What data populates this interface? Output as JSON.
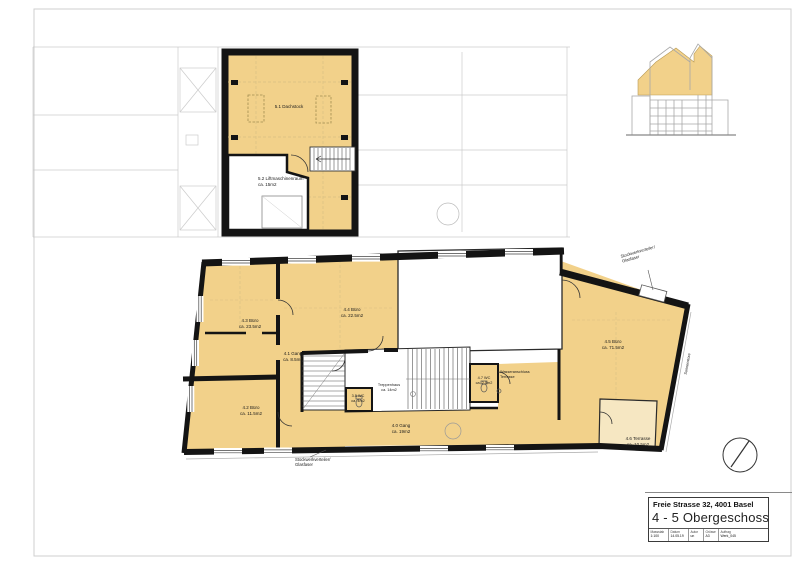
{
  "colors": {
    "room_fill": "#f2d18a",
    "terrace_fill": "#f6e7c2",
    "wall": "#141414",
    "faint_context": "#cccccc"
  },
  "attic": {
    "dachstock_label": "5.1 Dachstock",
    "lift_room_line1": "5.2 Liftmaschinenraum",
    "lift_room_line2": "ca. 15m2"
  },
  "floor": {
    "gang41": {
      "name": "4.1 Gang",
      "area": "ca. 8.5m2"
    },
    "buero42": {
      "name": "4.2 Büro",
      "area": "ca. 11.5m2"
    },
    "buero43": {
      "name": "4.3 Büro",
      "area": "ca. 23.5m2"
    },
    "buero44": {
      "name": "4.4 Büro",
      "area": "ca. 22.5m2"
    },
    "buero45": {
      "name": "4.5 Büro",
      "area": "ca. 71.5m2"
    },
    "terrasse46": {
      "name": "4.6 Terrasse",
      "area": "ca. 10.5m2"
    },
    "gang40": {
      "name": "4.0 Gang",
      "area": "ca. 19m2"
    },
    "wc35": {
      "name": "3.5 WC",
      "area": "ca. 4m2"
    },
    "wc47": {
      "name": "4.7 WC",
      "area": "ca. 2.5m2"
    },
    "treppenhaus": {
      "name": "Treppenhaus",
      "area": "ca. 14m2"
    }
  },
  "annotations": {
    "wasser_line1": "Wasseranschluss",
    "wasser_line2": "Terrasse",
    "verteiler_line1": "Stockwerkverteiler/",
    "verteiler_line2": "Glasfaser",
    "facade_note": "Sonnenstore"
  },
  "title_block": {
    "address": "Freie Strasse 32, 4001 Basel",
    "plan_title": "4 - 5 Obergeschoss",
    "meta": [
      {
        "label": "Massstab",
        "value": "1:100"
      },
      {
        "label": "Datum",
        "value": "14.05.19"
      },
      {
        "label": "Autor",
        "value": "un"
      },
      {
        "label": "Grösse",
        "value": "A3"
      },
      {
        "label": "Auftrag",
        "value": "Werk_045"
      }
    ]
  }
}
